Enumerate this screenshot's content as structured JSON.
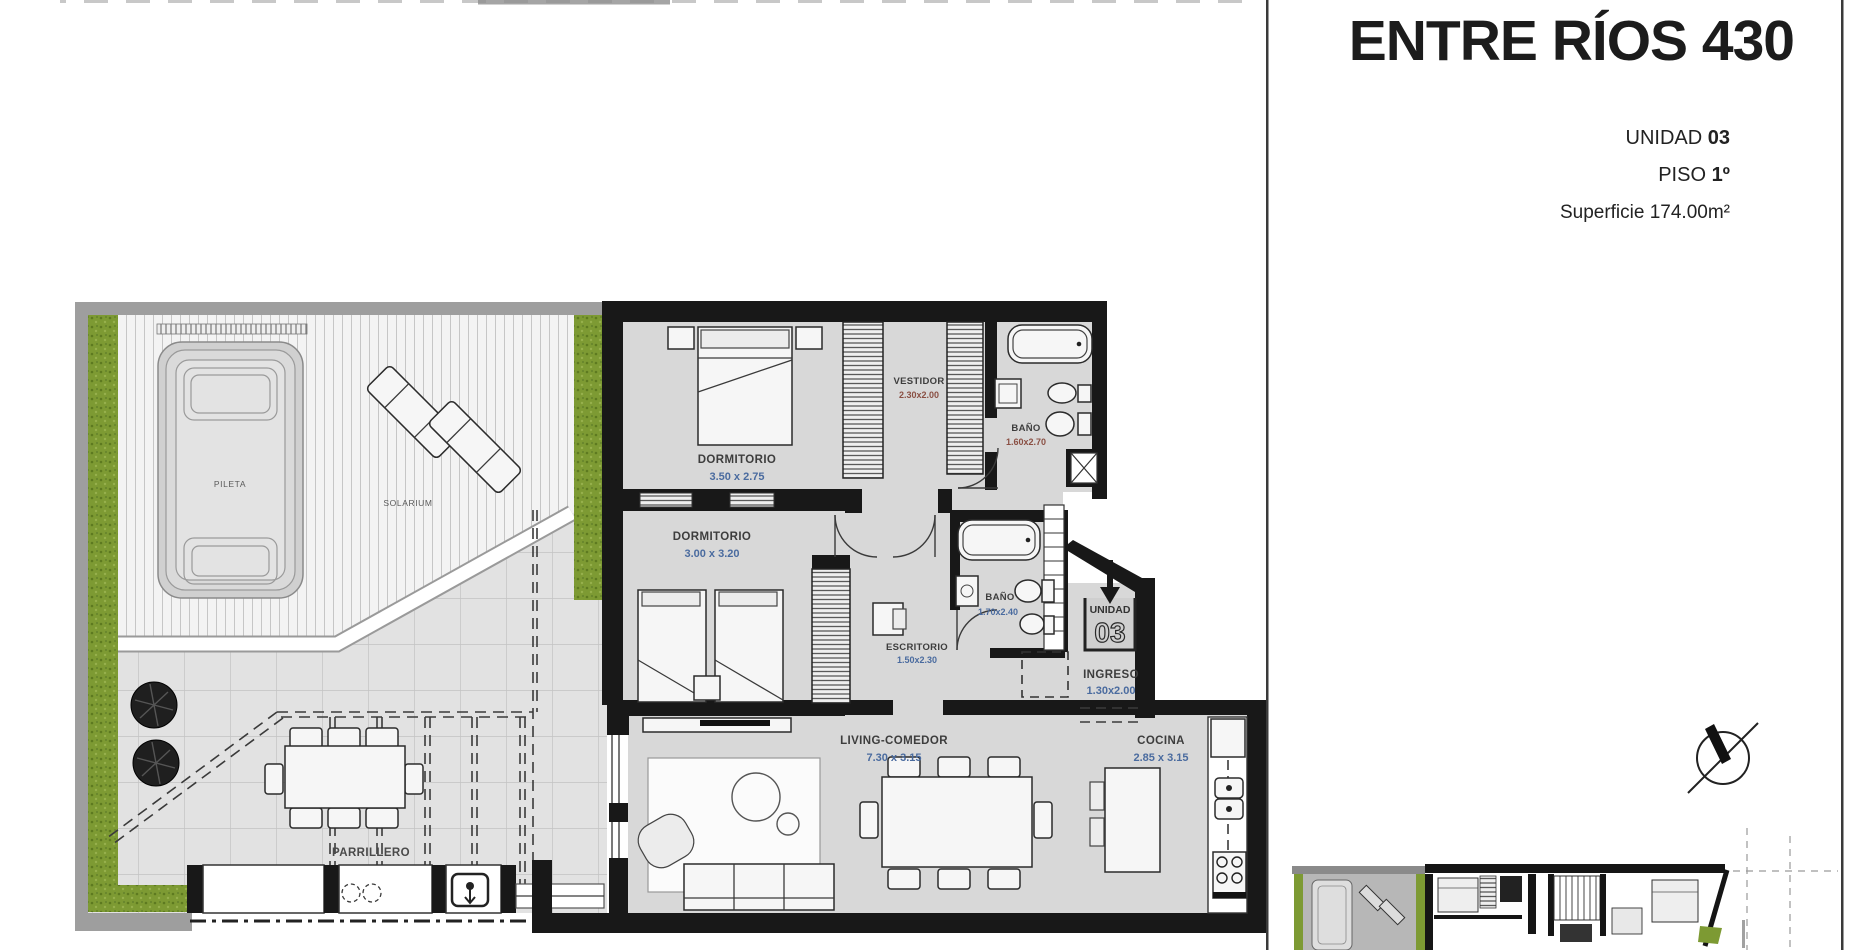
{
  "title_block": {
    "title": "ENTRE RÍOS 430",
    "unit_label": "UNIDAD",
    "unit_number": "03",
    "floor_label": "PISO",
    "floor_number": "1º",
    "area_label": "Superficie 174.00m²"
  },
  "plan": {
    "rooms": [
      {
        "id": "pileta",
        "name": "PILETA",
        "dims": ""
      },
      {
        "id": "solarium",
        "name": "SOLARIUM",
        "dims": ""
      },
      {
        "id": "dormitorio-1",
        "name": "DORMITORIO",
        "dims": "3.50 x 2.75"
      },
      {
        "id": "vestidor",
        "name": "VESTIDOR",
        "dims": "2.30x2.00"
      },
      {
        "id": "banio-1",
        "name": "BAÑO",
        "dims": "1.60x2.70"
      },
      {
        "id": "dormitorio-2",
        "name": "DORMITORIO",
        "dims": "3.00 x 3.20"
      },
      {
        "id": "banio-2",
        "name": "BAÑO",
        "dims": "1.70x2.40"
      },
      {
        "id": "escritorio",
        "name": "ESCRITORIO",
        "dims": "1.50x2.30"
      },
      {
        "id": "ingreso",
        "name": "INGRESO",
        "dims": "1.30x2.00"
      },
      {
        "id": "living-comedor",
        "name": "LIVING-COMEDOR",
        "dims": "7.30 x 3.15"
      },
      {
        "id": "cocina",
        "name": "COCINA",
        "dims": "2.85 x 3.15"
      },
      {
        "id": "parrillero",
        "name": "PARRILLERO",
        "dims": ""
      }
    ],
    "entry_marker": {
      "label": "UNIDAD",
      "number": "03"
    },
    "icons": {
      "compass": "north-compass-icon",
      "entry_arrow": "entry-arrow-icon"
    },
    "colors": {
      "wall": "#181818",
      "floor": "#d8d8d8",
      "terrace_band": "#9e9e9e",
      "hedge_green": "#7d9a33",
      "dim_blue": "#4a6b9f",
      "dim_red": "#8a4f43",
      "room_label": "#3d3d3d",
      "minor_label": "#5a5a5a",
      "mini_highlight": "#b7b7b7"
    }
  }
}
